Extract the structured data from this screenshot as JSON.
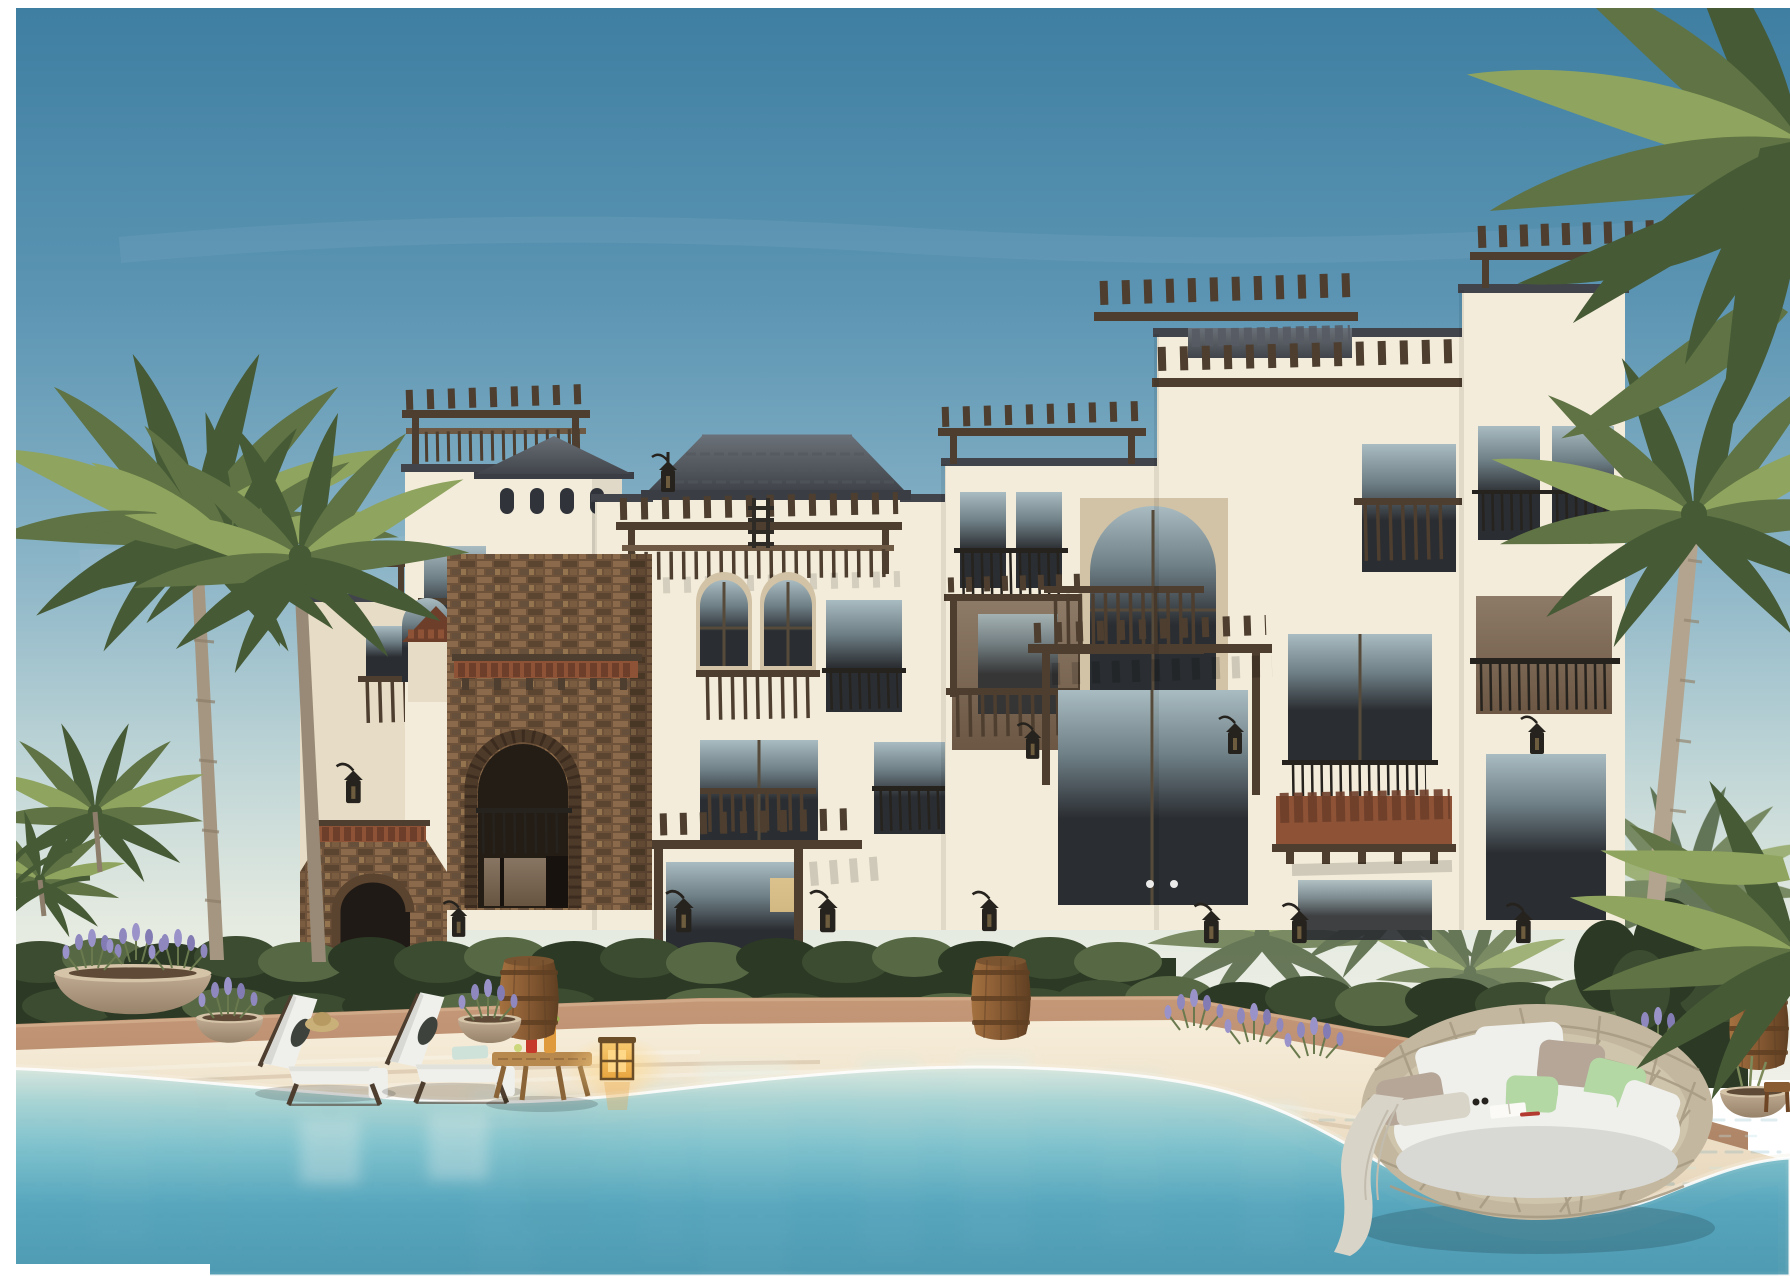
{
  "meta": {
    "title": "Seafront Mediterranean villas — architectural rendering",
    "description": "Render of a three-storey cream villa complex with wooden pergolas, balconies, a rustic brick arch tower, palm trees, hedges, a sandy beach with sun loungers, cocktail table, glowing lantern and wine barrels, and a round wicker daybed beside a turquoise swimming lagoon."
  },
  "scene": {
    "sky": "Clear blue sky fading to a pale warm horizon",
    "buildings": "Cream stucco villa block with flat parapets, dark tile copings, a hipped tile roof, a pyramid-roof cupola and rooftop wooden pergolas",
    "brick_tower": "Rustic brick entrance tower with a tall arched doorway, juliet railing and terracotta tile canopies",
    "pergolas": "Dark timber pergolas casting striped shadows over balconies and entrances",
    "windows": "Large dark glass windows and doors, arched windows, wood and iron juliet balconies, wall lanterns",
    "palms_left": "Two tall coconut palms and a small golden palm on the left bank",
    "palms_right": "Palm crowns leaning in from the top-right corner with a curved trunk",
    "hedge": "Dense clipped green hedge running along the building base",
    "umbrella": "Distant white parasol behind the hedge on the left",
    "walkway": "Terracotta paved walkway behind the beach",
    "beach": "Pale sandy beach shelving into the water",
    "lagoon": "Turquoise swimming lagoon with rippled reflections of the villas",
    "loungers": "Two wicker sun loungers with white cushions, a straw hat and folded towel, feet standing in the water",
    "side_table": "Low wooden slat table holding a red and an orange cocktail",
    "lantern": "Glowing amber cube lantern on the sand",
    "barrels": "Wooden wine barrels used as planters along the walkway",
    "planters": "Stone bowl planters with lavender",
    "daybed": "Round woven wicker daybed with white, taupe and green pillows, a draped blanket, an open book and sunglasses"
  },
  "palette": {
    "border": "#ffffff",
    "sky_top": "#3e7ea1",
    "sky_upper": "#5c95b3",
    "sky_mid": "#8ab4c7",
    "sky_low": "#c2d7d7",
    "sky_horizon": "#e6ebe1",
    "sky_base": "#eff0e8",
    "wall": "#f3ecda",
    "wall_shade": "#e7dcc5",
    "wall_deep": "#d2c3a6",
    "wood_light": "#8d7660",
    "wood_mid": "#6e5944",
    "wood_dark": "#4d3e2f",
    "roof_dark": "#41454b",
    "roof_light": "#6a7077",
    "terra": "#8e5336",
    "terra_dark": "#6d3f2a",
    "glass_hi": "#a9bcc1",
    "glass_mid": "#6f8087",
    "glass_dark": "#2a2d31",
    "glass_warm": "#8d7a67",
    "warm_light": "#e9c887",
    "brick": "#6e523a",
    "brick_dark": "#5c4530",
    "brick_light": "#8a6a4a",
    "hedge": "#3c4c31",
    "hedge_dark": "#2c3a25",
    "hedge_light": "#566844",
    "palm": "#5f7344",
    "palm_dark": "#465a36",
    "palm_light": "#8fa45e",
    "palm_pale": "#b7c47e",
    "trunk": "#a59681",
    "walkway": "#c59878",
    "walkway_dark": "#ad8466",
    "sand_hi": "#f6edd9",
    "sand": "#eadac0",
    "sand_shadow": "#cdb79c",
    "water_edge": "#d8e8e0",
    "water_light": "#a9d4d4",
    "water_mid": "#7fc2cd",
    "water_deep": "#57a6bd",
    "water_dark": "#4e9ab2",
    "cushion": "#eff0ec",
    "cushion_shade": "#d8d9d4",
    "pillow_taupe": "#b5a698",
    "pillow_green": "#b4d8a4",
    "wicker": "#c3b79f",
    "wicker_dark": "#a99c84",
    "barrel_light": "#a4713f",
    "barrel_dark": "#5f3f22",
    "lantern_glow": "#f2b65c",
    "metal": "#26221d",
    "cocktail_red": "#c63a2c",
    "cocktail_orange": "#e09a3e",
    "table_wood": "#b8894e",
    "stone_light": "#c8b49a",
    "stone_dark": "#97826a",
    "umbrella": "#f4f2ea",
    "blanket": "#d9d4c8"
  }
}
